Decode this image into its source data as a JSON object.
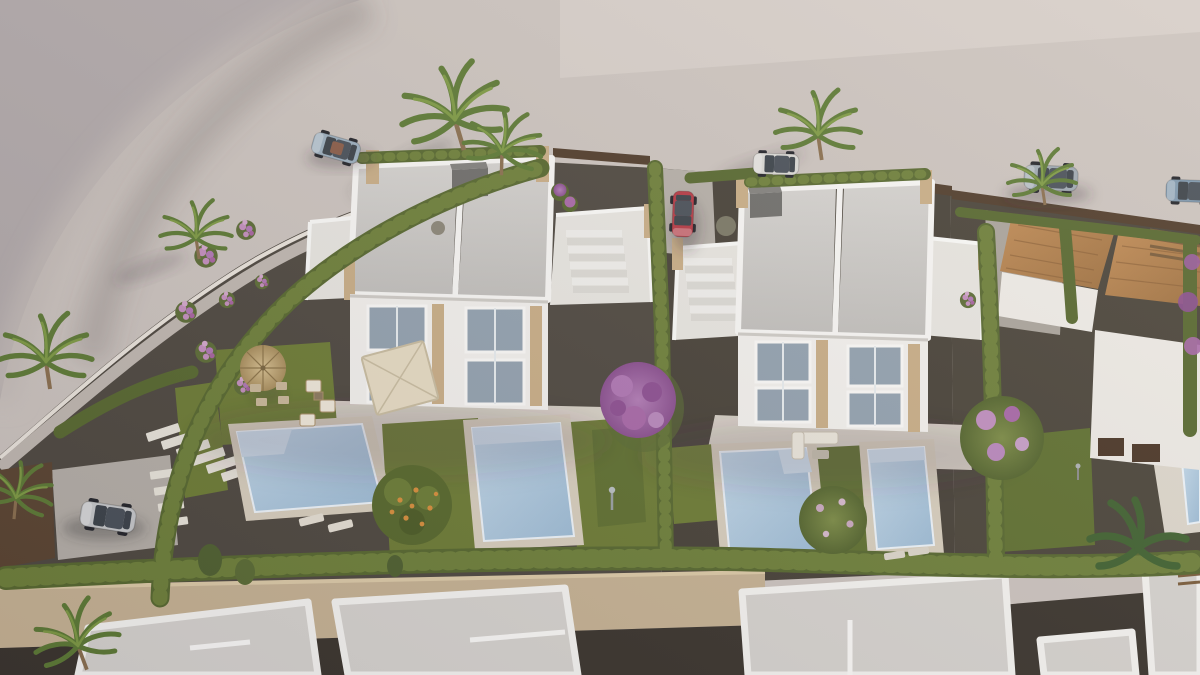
{
  "image": {
    "kind": "aerial-3d-architectural-render",
    "description": "Bird's-eye render of a residential development: two modern white duplex villas with roof terraces and private pools, landscaped gardens with hedges and palms, a curved road with parked cars, terracotta-roof houses at right, stone perimeter wall and flat-roofed houses at the bottom"
  },
  "palette": {
    "road": "#ccc4bf",
    "ground_far": "#b2aaab",
    "road_light": "#d7d0ca",
    "curb": "#eae4dc",
    "gravel": "#4e4840",
    "gravel_right": "#474138",
    "gravel_far": "#4a443a",
    "grass": "#6d7c35",
    "grass_dark": "#5f7030",
    "hedge": "#57682f",
    "hedge_light": "#6e803a",
    "pool_water": "#a9c6dd",
    "pool_step": "#cfe0ee",
    "pool_coping": "#d8cfbe",
    "villa_wall": "#f3f1ee",
    "deck_white": "#e8e6e1",
    "roof": "#cac8c5",
    "parapet": "#f8f7f5",
    "stone": "#c9ae87",
    "glass": "#93a2b0",
    "terrace": "#d9d3c8",
    "driveway": "#b5afa8",
    "wall_stone": "#c7b394",
    "road_dark": "#3a342d",
    "building_roof": "#d7d4d0",
    "fence_brown": "#503c2b",
    "gate_brown": "#5a4431",
    "terracotta": "#b5824e",
    "pergola_wood": "#7a5c3a",
    "purple": "#9a5b9e",
    "pink": "#c48fbe",
    "citrus": "#57682c",
    "orange": "#d78f3c",
    "straw": "#c9b184",
    "cream": "#e7dcc4",
    "chimney": "#6f6e6b"
  },
  "cars": {
    "convertible_top_left": {
      "color": "#9cafbe",
      "label": "silver-blue convertible on road"
    },
    "estate_by_palms": {
      "color": "#dad9d5",
      "label": "white estate car by palm trees"
    },
    "suv_top_right": {
      "color": "#9fa9b2",
      "label": "grey SUV on upper road"
    },
    "car_far_right": {
      "color": "#7e97ad",
      "label": "blue car at right edge"
    },
    "hatchback_red": {
      "color": "#b53a45",
      "label": "red hatchback in driveway"
    },
    "suv_driveway": {
      "color": "#c6c8ca",
      "label": "silver SUV in left driveway"
    }
  },
  "scene": {
    "setting": "sunlit coastal residential development, light from upper right",
    "villas": [
      {
        "name": "villa-left",
        "units": 2,
        "pools": 2,
        "roof_terraces": 2
      },
      {
        "name": "villa-right",
        "units": 2,
        "pools": 2,
        "roof_terraces": 2
      }
    ],
    "pools_visible": 5,
    "objects": [
      "vacant mauve lot",
      "curved road",
      "white duplex villas",
      "roof stairs",
      "cypress hedges",
      "stone perimeter wall",
      "service road",
      "flat-roof houses",
      "terracotta-roof houses",
      "palm trees",
      "banana plant",
      "bougainvillea",
      "citrus tree",
      "straw parasol",
      "square parasol",
      "garden furniture",
      "stepping stones",
      "parked cars"
    ]
  }
}
